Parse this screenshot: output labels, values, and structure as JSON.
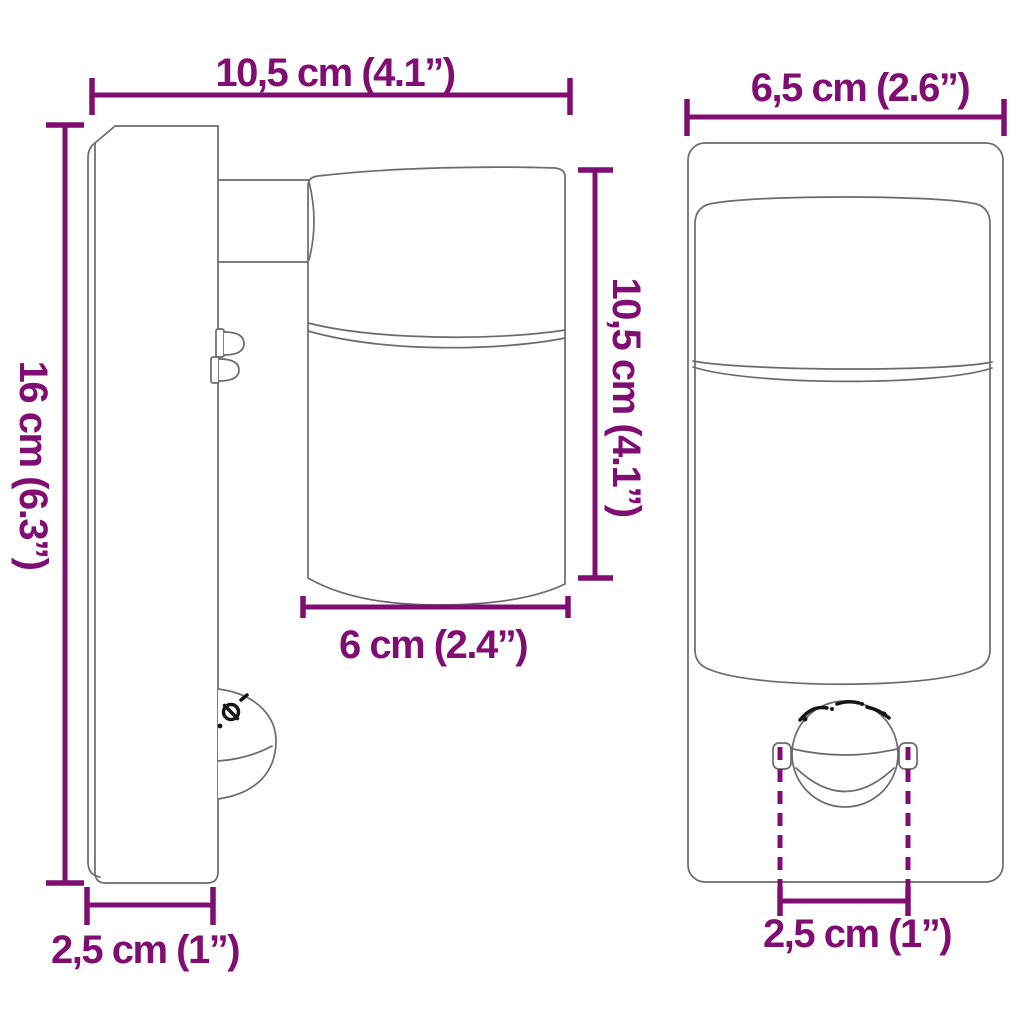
{
  "diagram": {
    "subject": "wall light with motion sensor - dimension drawing",
    "side_view": {
      "dims": {
        "total_width": "10,5 cm (4.1”)",
        "total_height": "16 cm (6.3”)",
        "head_height": "10,5 cm (4.1”)",
        "head_diameter": "6 cm (2.4”)",
        "plate_depth": "2,5 cm (1”)"
      }
    },
    "front_view": {
      "dims": {
        "width": "6,5 cm (2.6”)",
        "sensor_width": "2,5 cm (1”)"
      }
    }
  },
  "colors": {
    "accent": "#800E72",
    "drawing_line": "#6b6b6b",
    "engraving_ink": "#141414",
    "background": "#ffffff"
  }
}
